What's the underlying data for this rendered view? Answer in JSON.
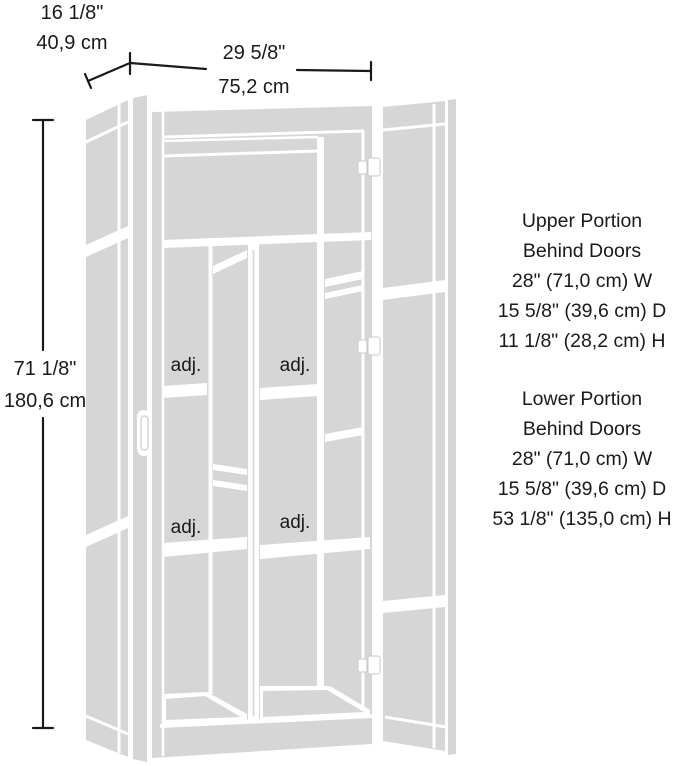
{
  "diagram": {
    "type": "furniture-dimension-diagram",
    "subject": "tall storage cabinet with both doors open",
    "colors": {
      "panel_gray": "#d6d6d6",
      "line_white": "#ffffff",
      "ink": "#1a1a1a"
    },
    "dimensions": {
      "depth": {
        "imperial": "16 1/8\"",
        "metric": "40,9 cm"
      },
      "width": {
        "imperial": "29 5/8\"",
        "metric": "75,2 cm"
      },
      "height": {
        "imperial": "71 1/8\"",
        "metric": "180,6 cm"
      }
    },
    "shelf_labels": {
      "upper_left": "adj.",
      "upper_right": "adj.",
      "lower_left": "adj.",
      "lower_right": "adj."
    },
    "annotations": {
      "upper_portion": {
        "lines": [
          "Upper Portion",
          "Behind Doors",
          "28\" (71,0 cm) W",
          "15 5/8\" (39,6 cm) D",
          "11 1/8\" (28,2 cm) H"
        ]
      },
      "lower_portion": {
        "lines": [
          "Lower Portion",
          "Behind Doors",
          "28\" (71,0 cm) W",
          "15 5/8\" (39,6 cm) D",
          "53 1/8\" (135,0 cm) H"
        ]
      }
    }
  }
}
